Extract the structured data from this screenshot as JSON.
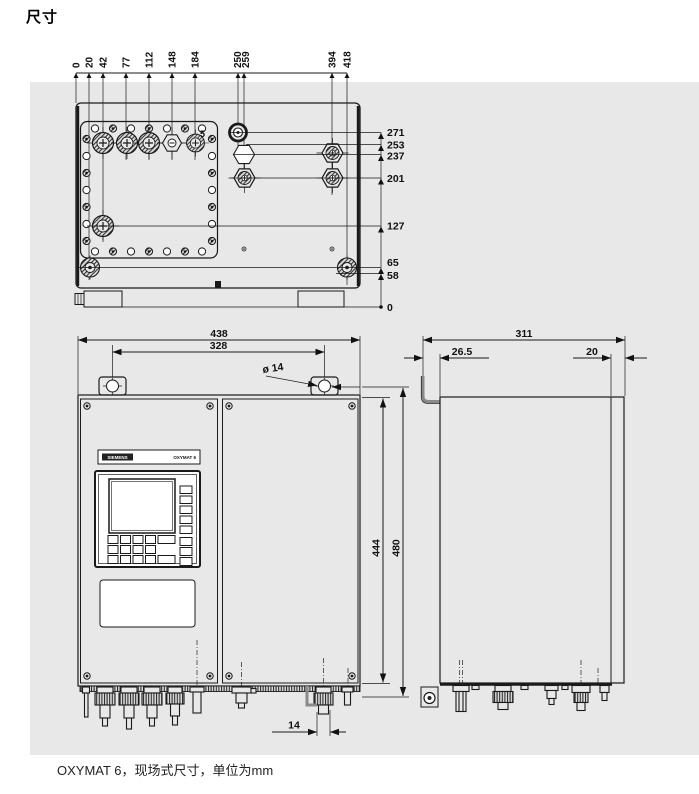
{
  "page": {
    "title": "尺寸",
    "caption": "OXYMAT 6，现场式尺寸，单位为mm"
  },
  "top_view": {
    "x_ticks": [
      "0",
      "20",
      "42",
      "77",
      "112",
      "148",
      "184",
      "250",
      "259",
      "394",
      "418"
    ],
    "y_ticks": [
      "271",
      "253",
      "237",
      "201",
      "127",
      "65",
      "58",
      "0"
    ],
    "note": "5"
  },
  "front_view": {
    "overall_width": "438",
    "hole_spacing": "328",
    "hole_diameter": "ø 14",
    "door_height": "444",
    "overall_height": "480",
    "gland_offset": "14",
    "brand": "SIEMENS",
    "model": "OXYMAT 6"
  },
  "side_view": {
    "depth": "311",
    "bracket_offset": "26.5",
    "rear_offset": "20"
  }
}
